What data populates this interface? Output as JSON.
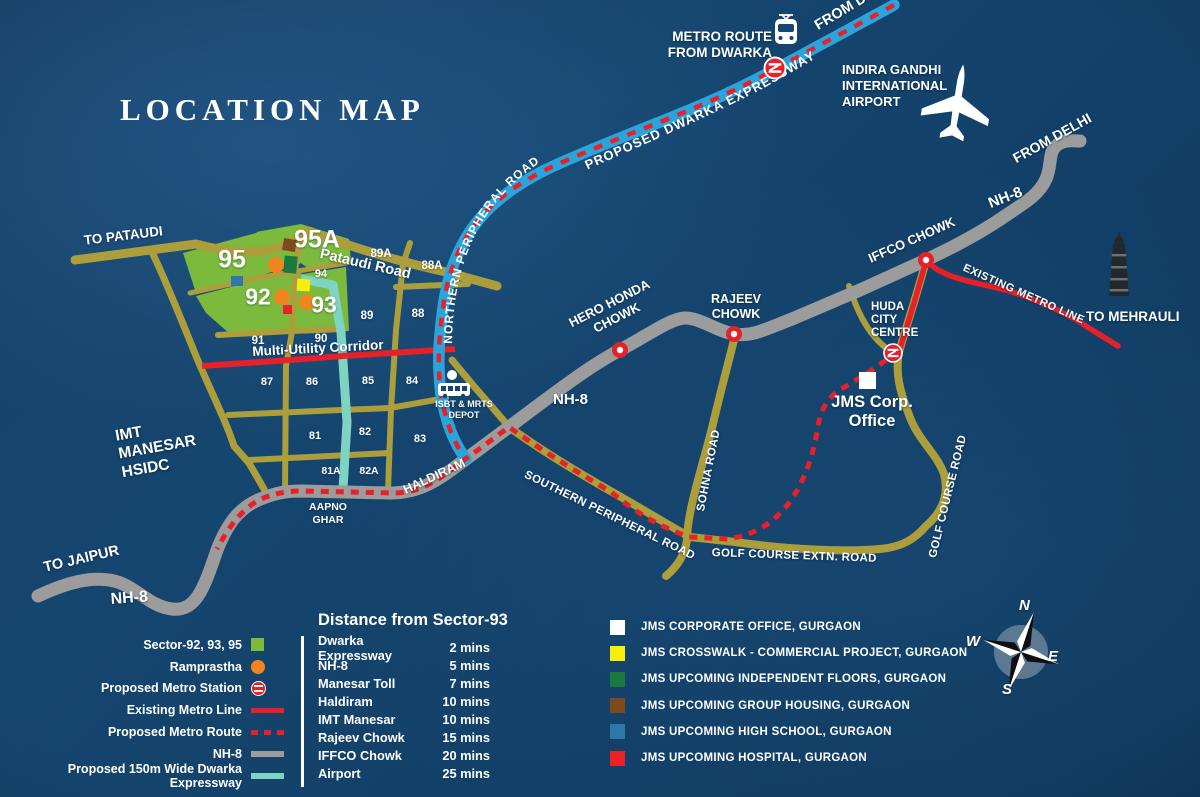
{
  "title": "LOCATION MAP",
  "colors": {
    "background": "#15466f",
    "road_yellow": "#ac9e3a",
    "road_gray": "#9c9c9c",
    "expressway_blue": "#2aa5dc",
    "expressway_teal": "#7fd3c3",
    "metro_red": "#e62129",
    "sector_green": "#7cba3d",
    "ramprastha_orange": "#f0851f"
  },
  "map_labels": {
    "from_delhi_top": "FROM DELHI",
    "metro_route_from_dwarka": "METRO ROUTE\nFROM DWARKA",
    "proposed_dwarka_expressway": "PROPOSED DWARKA EXPRESSWAY",
    "indira_gandhi_airport": "INDIRA GANDHI\nINTERNATIONAL\nAIRPORT",
    "from_delhi_right": "FROM DELHI",
    "nh8_top_right": "NH-8",
    "iffco_chowk": "IFFCO CHOWK",
    "existing_metro_line": "EXISTING METRO LINE",
    "to_mehrauli": "TO MEHRAULI",
    "northern_peripheral_road": "NORTHERN PERIPHERAL ROAD",
    "pataudi_road": "Pataudi Road",
    "to_pataudi": "TO PATAUDI",
    "hero_honda_chowk": "HERO HONDA\nCHOWK",
    "rajeev_chowk": "RAJEEV\nCHOWK",
    "huda_city_centre": "HUDA\nCITY\nCENTRE",
    "jms_corp_office": "JMS Corp.\nOffice",
    "multi_utility_corridor": "Multi-Utility Corridor",
    "nh8_mid": "NH-8",
    "nh8_bottom": "NH-8",
    "sohna_road": "SOHNA ROAD",
    "golf_course_road": "GOLF COURSE ROAD",
    "golf_course_extn_road": "GOLF COURSE EXTN. ROAD",
    "southern_peripheral_road": "SOUTHERN PERIPHERAL ROAD",
    "haldiram": "HALDIRAM",
    "aapno_ghar": "AAPNO\nGHAR",
    "isbt_depot": "ISBT & MRTS\nDEPOT",
    "imt_manesar": "IMT\nMANESAR\nHSIDC",
    "to_jaipur": "TO JAIPUR"
  },
  "sectors": [
    {
      "n": "95",
      "x": 232,
      "y": 260,
      "size": 25
    },
    {
      "n": "95A",
      "x": 317,
      "y": 240,
      "size": 25
    },
    {
      "n": "92",
      "x": 258,
      "y": 297,
      "size": 23
    },
    {
      "n": "93",
      "x": 324,
      "y": 305,
      "size": 23
    },
    {
      "n": "94",
      "x": 321,
      "y": 274,
      "size": 11
    },
    {
      "n": "89A",
      "x": 381,
      "y": 254,
      "size": 11.5
    },
    {
      "n": "88A",
      "x": 432,
      "y": 266,
      "size": 11.5
    },
    {
      "n": "89",
      "x": 367,
      "y": 316,
      "size": 11.5
    },
    {
      "n": "88",
      "x": 418,
      "y": 314,
      "size": 11.5
    },
    {
      "n": "90",
      "x": 321,
      "y": 339,
      "size": 11.5
    },
    {
      "n": "91",
      "x": 258,
      "y": 341,
      "size": 11.5
    },
    {
      "n": "87",
      "x": 267,
      "y": 382,
      "size": 11
    },
    {
      "n": "86",
      "x": 312,
      "y": 382,
      "size": 11
    },
    {
      "n": "85",
      "x": 368,
      "y": 381,
      "size": 11
    },
    {
      "n": "84",
      "x": 412,
      "y": 381,
      "size": 11
    },
    {
      "n": "81",
      "x": 315,
      "y": 436,
      "size": 11
    },
    {
      "n": "82",
      "x": 365,
      "y": 432,
      "size": 11
    },
    {
      "n": "83",
      "x": 420,
      "y": 439,
      "size": 11
    },
    {
      "n": "81A",
      "x": 331,
      "y": 471,
      "size": 10.5
    },
    {
      "n": "82A",
      "x": 369,
      "y": 471,
      "size": 10.5
    }
  ],
  "compass": {
    "n": "N",
    "e": "E",
    "w": "W",
    "s": "S"
  },
  "legend_left": {
    "items": [
      {
        "label": "Sector-92, 93, 95",
        "swatch": "green-square"
      },
      {
        "label": "Ramprastha",
        "swatch": "orange-circle"
      },
      {
        "label": "Proposed Metro Station",
        "swatch": "metro-icon"
      },
      {
        "label": "Existing Metro Line",
        "swatch": "red-line"
      },
      {
        "label": "Proposed Metro Route",
        "swatch": "red-dashed"
      },
      {
        "label": "NH-8",
        "swatch": "gray-line"
      },
      {
        "label": "Proposed 150m Wide Dwarka Expressway",
        "swatch": "teal-line"
      }
    ]
  },
  "distance_table": {
    "title": "Distance from Sector-93",
    "rows": [
      {
        "place": "Dwarka Expressway",
        "time": "2 mins"
      },
      {
        "place": "NH-8",
        "time": "5 mins"
      },
      {
        "place": "Manesar Toll",
        "time": "7 mins"
      },
      {
        "place": "Haldiram",
        "time": "10 mins"
      },
      {
        "place": "IMT Manesar",
        "time": "10 mins"
      },
      {
        "place": "Rajeev Chowk",
        "time": "15 mins"
      },
      {
        "place": "IFFCO Chowk",
        "time": "20 mins"
      },
      {
        "place": "Airport",
        "time": "25 mins"
      }
    ]
  },
  "legend_right": {
    "items": [
      {
        "label": "JMS CORPORATE OFFICE, GURGAON",
        "color": "#ffffff"
      },
      {
        "label": "JMS CROSSWALK - COMMERCIAL PROJECT, GURGAON",
        "color": "#f9ed0c"
      },
      {
        "label": "JMS UPCOMING INDEPENDENT FLOORS, GURGAON",
        "color": "#19793f"
      },
      {
        "label": "JMS UPCOMING GROUP HOUSING, GURGAON",
        "color": "#7c4a1d"
      },
      {
        "label": "JMS UPCOMING HIGH SCHOOL, GURGAON",
        "color": "#2d77a9"
      },
      {
        "label": "JMS UPCOMING HOSPITAL, GURGAON",
        "color": "#ea2127"
      }
    ]
  }
}
